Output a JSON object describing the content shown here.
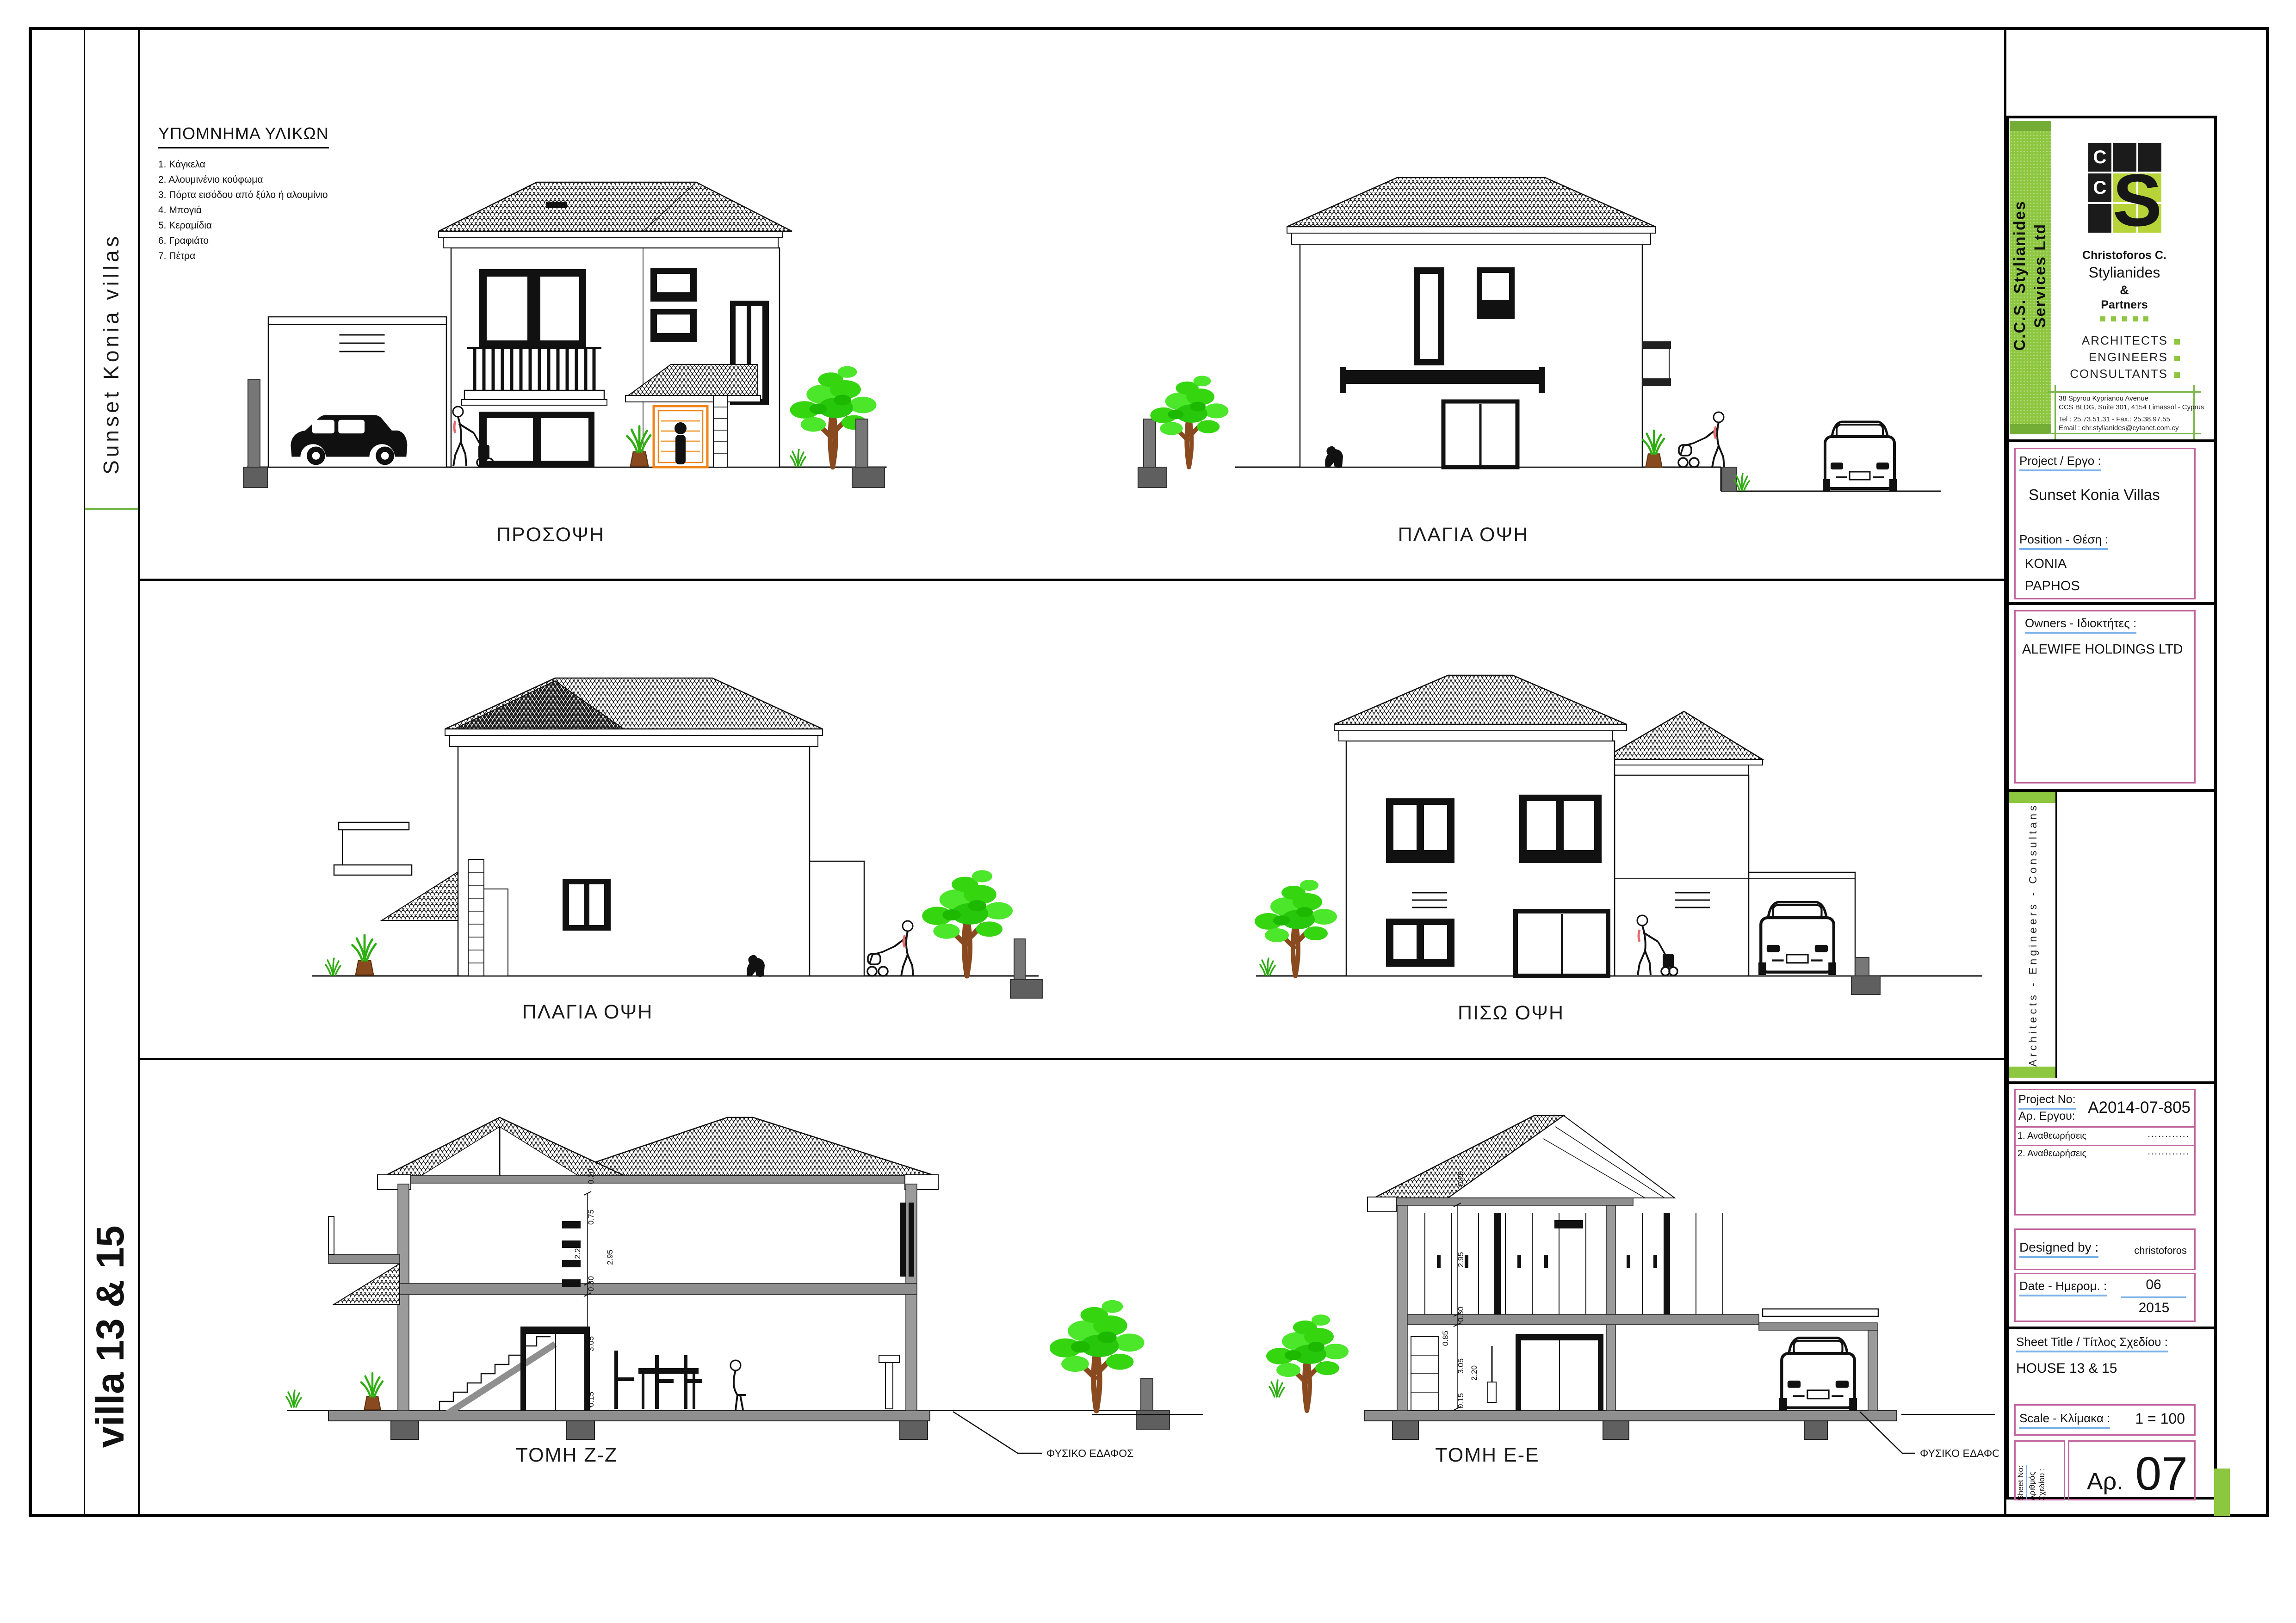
{
  "sheet": {
    "side_top": "Sunset  Konia  villas",
    "side_bottom": "villa 13 & 15"
  },
  "legend": {
    "title": "ΥΠΟΜΝΗΜΑ ΥΛΙΚΩΝ",
    "items": [
      "1. Κάγκελα",
      "2. Αλουμινένιο κούφωμα",
      "3. Πόρτα εισόδου από ξύλο ή αλουμίνιο",
      "4. Μπογιά",
      "5. Κεραμίδια",
      "6. Γραφιάτο",
      "7. Πέτρα"
    ]
  },
  "drawings": {
    "front": {
      "label": "ΠΡΟΣΟΨΗ"
    },
    "side_top": {
      "label": "ΠΛΑΓΙΑ ΟΨΗ"
    },
    "side_mid": {
      "label": "ΠΛΑΓΙΑ ΟΨΗ"
    },
    "rear": {
      "label": "ΠΙΣΩ ΟΨΗ"
    },
    "section_z": {
      "label": "ΤΟΜΗ Z-Z",
      "ground_note": "ΦΥΣΙΚΟ ΕΔΑΦΟΣ",
      "dims": [
        "0.20",
        "0.75",
        "2.20",
        "2.95",
        "0.30",
        "3.05",
        "0.15"
      ]
    },
    "section_e": {
      "label": "ΤΟΜΗ E-E",
      "ground_note": "ΦΥΣΙΚΟ ΕΔΑΦΟΣ",
      "dims": [
        "0.20",
        "2.95",
        "0.30",
        "0.85",
        "3.05",
        "2.20",
        "0.15"
      ]
    }
  },
  "titleblock": {
    "band_line1": "C.C.S.  Stylianides",
    "band_line2": "Services Ltd",
    "logo": {
      "c_top": "C",
      "c_mid": "C",
      "s": "S"
    },
    "firm_name1": "Christoforos  C.",
    "firm_name2": "Stylianides",
    "firm_amp": "&",
    "firm_name3": "Partners",
    "roles": [
      "ARCHITECTS",
      "ENGINEERS",
      "CONSULTANTS"
    ],
    "address1": "38 Spyrou Kyprianou Avenue",
    "address2": "CCS BLDG, Suite 301, 4154 Limassol - Cyprus",
    "address3": "Tel : 25.73.51.31  - Fax.: 25.38.97.55",
    "address4": "Email :  chr.stylianides@cytanet.com.cy",
    "project_label": "Project /  Εργο :",
    "project_value": "Sunset  Konia Villas",
    "position_label": "Position -  Θέση :",
    "position_value1": "KONIA",
    "position_value2": "PAPHOS",
    "owners_label": "Owners  -  Ιδιοκτήτες :",
    "owners_value": "ALEWIFE  HOLDINGS  LTD",
    "side_strip": "Architects - Engineers - Consultans",
    "project_no_label_en": "Project No:",
    "project_no_label_gr": "Αρ. Εργου:",
    "project_no_value": "A2014-07-805",
    "revision1": "1. Αναθεωρήσεις",
    "revision2": "2. Αναθεωρήσεις",
    "revision_dots": "............",
    "designed_label": "Designed by :",
    "designed_value": "christoforos",
    "date_label": "Date -  Ημερομ. :",
    "date_month": "06",
    "date_year": "2015",
    "sheet_title_label": "Sheet  Title  /   Τίτλος Σχεδίου :",
    "sheet_title_value": "HOUSE  13 & 15",
    "scale_label": "Scale - Κλίμακα :",
    "scale_value": "1 = 100",
    "sheet_no_label1": "Sheet No:",
    "sheet_no_label2": "Αριθμός",
    "sheet_no_label3": "Σχεδίου :",
    "sheet_no_prefix": "Αρ.",
    "sheet_no_value": "07"
  },
  "colors": {
    "accent_green": "#8dc63f",
    "accent_green_dark": "#74ad35",
    "pink_border": "#c0649e",
    "blue_underline": "#79b1e8",
    "door_orange": "#ef8318",
    "tree_green": "#35d60f"
  }
}
